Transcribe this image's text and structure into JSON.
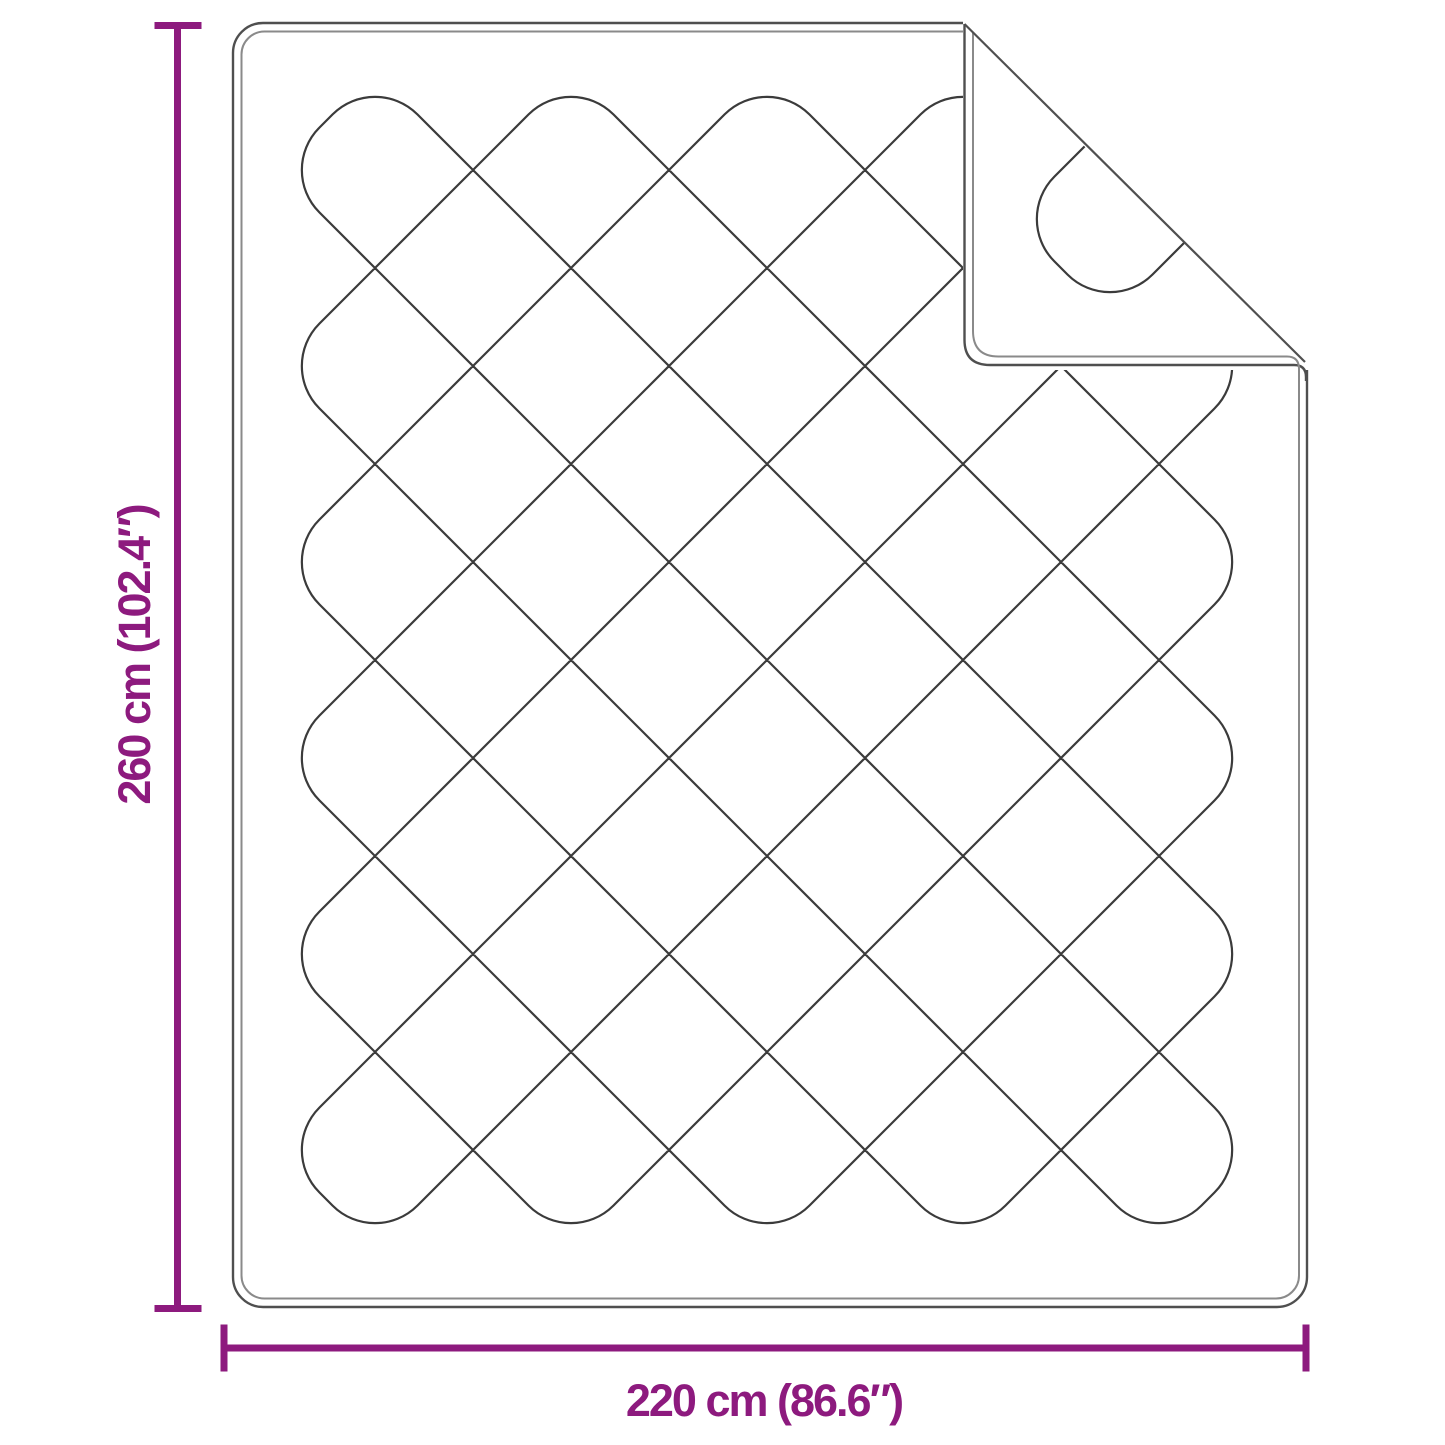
{
  "diagram": {
    "title": "Blanket dimension diagram",
    "product": "Quilted blanket with folded-over top right corner",
    "background": "#ffffff",
    "accent_color": "#8D1A7E",
    "stitch_line_color": "#3b3b3b",
    "outline_color": "#4f4f4f",
    "dimensions": {
      "height": {
        "label": "260 cm (102.4″)",
        "cm": 260,
        "inches": 102.4
      },
      "width": {
        "label": "220 cm (86.6″)",
        "cm": 220,
        "inches": 86.6
      }
    }
  }
}
